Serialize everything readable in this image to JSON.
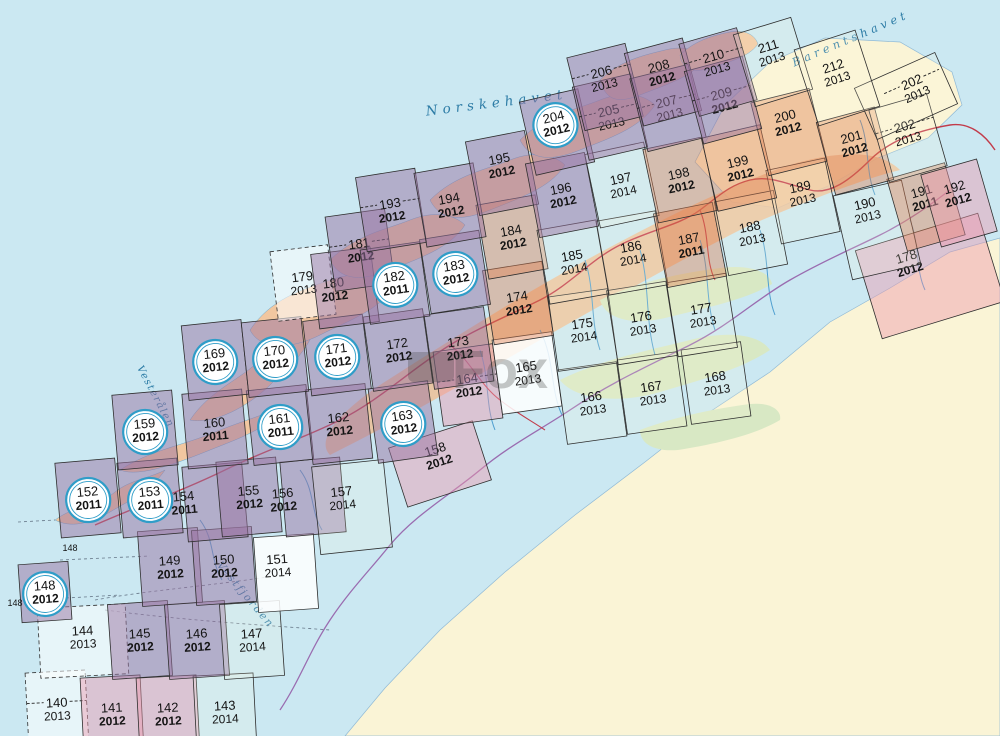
{
  "map": {
    "colors": {
      "sea": "#cbe8f2",
      "paper": "#faf4d6",
      "island": "#f1c7a0",
      "band": "#edbf97",
      "green": "#d8e8c4",
      "river": "#4f9fd0",
      "road": "#c23b4a",
      "border": "#9a6cb0",
      "grid": "#2e2e2e",
      "label": "#141414",
      "circle": "#2f9dc8",
      "sea_text": "#2d7ca6",
      "dashline": "#667788",
      "watermark": "rgba(70,70,70,0.30)",
      "tints": {
        "purple": "rgba(154,116,162,0.50)",
        "pink": "rgba(238,152,172,0.45)",
        "salmon": "rgba(224,128,84,0.42)",
        "white": "rgba(255,255,255,0.85)",
        "whiteSea": "rgba(255,255,255,0.55)",
        "plain": "rgba(255,250,220,0.18)"
      }
    },
    "sea_labels": [
      {
        "id": "norskehavet",
        "t": "Norskehavet",
        "x": 497,
        "y": 107,
        "rot": -7,
        "fs": 13.5,
        "ls": 5
      },
      {
        "id": "barentshavet",
        "t": "Barentshavet",
        "x": 852,
        "y": 42,
        "rot": -23,
        "fs": 11.5,
        "ls": 4
      },
      {
        "id": "vestfjorden",
        "t": "Vestfjorden",
        "x": 243,
        "y": 597,
        "rot": 50,
        "fs": 10.5,
        "ls": 2
      },
      {
        "id": "vesteralen",
        "t": "Vesterålen",
        "x": 153,
        "y": 398,
        "rot": 62,
        "fs": 10,
        "ls": 1.5
      }
    ],
    "extra_labels": [
      {
        "t": "148",
        "x": 70,
        "y": 551
      },
      {
        "t": "148",
        "x": 15,
        "y": 606
      }
    ],
    "watermark": {
      "t": "Fox",
      "x": 500,
      "y": 388
    },
    "sheets": [
      {
        "n": "140",
        "yr": "2013",
        "x": 57,
        "y": 705,
        "rot": -3,
        "tint": "whiteSea",
        "dbox": true,
        "dash": true
      },
      {
        "n": "141",
        "yr": "2012",
        "x": 112,
        "y": 710,
        "rot": -3,
        "tint": "pink"
      },
      {
        "n": "142",
        "yr": "2012",
        "x": 168,
        "y": 710,
        "rot": -3,
        "tint": "pink"
      },
      {
        "n": "143",
        "yr": "2014",
        "x": 225,
        "y": 708,
        "rot": -3,
        "tint": "plain"
      },
      {
        "n": "144",
        "yr": "2013",
        "x": 83,
        "y": 633,
        "rot": -3,
        "tint": "whiteSea",
        "w": 88,
        "h": 70,
        "cdy": 4,
        "dbox": true
      },
      {
        "n": "145",
        "yr": "2012",
        "x": 140,
        "y": 636,
        "rot": -4,
        "tint": "purple"
      },
      {
        "n": "146",
        "yr": "2012",
        "x": 197,
        "y": 636,
        "rot": -4,
        "tint": "purple"
      },
      {
        "n": "147",
        "yr": "2014",
        "x": 252,
        "y": 636,
        "rot": -4,
        "tint": "plain"
      },
      {
        "n": "148",
        "yr": "2012",
        "x": 45,
        "y": 588,
        "rot": -4,
        "tint": "purple",
        "circ": true,
        "w": 50,
        "h": 58
      },
      {
        "n": "149",
        "yr": "2012",
        "x": 170,
        "y": 563,
        "rot": -4,
        "tint": "purple"
      },
      {
        "n": "150",
        "yr": "2012",
        "x": 224,
        "y": 562,
        "rot": -4,
        "tint": "purple"
      },
      {
        "n": "151",
        "yr": "2014",
        "x": 278,
        "y": 561,
        "rot": -4,
        "tint": "white",
        "cdx": 8,
        "cdy": 8
      },
      {
        "n": "152",
        "yr": "2011",
        "x": 88,
        "y": 494,
        "rot": -5,
        "tint": "purple",
        "circ": true
      },
      {
        "n": "153",
        "yr": "2011",
        "x": 150,
        "y": 494,
        "rot": -5,
        "tint": "purple",
        "circ": true
      },
      {
        "n": "154",
        "yr": "2011",
        "x": 184,
        "y": 496,
        "rot": -5,
        "tint": "purple",
        "cdx": 31,
        "cdy": 2
      },
      {
        "n": "155",
        "yr": "2012",
        "x": 249,
        "y": 493,
        "rot": -5,
        "tint": "purple"
      },
      {
        "n": "156",
        "yr": "2012",
        "x": 283,
        "y": 493,
        "rot": -5,
        "tint": "purple",
        "cdx": 30
      },
      {
        "n": "157",
        "yr": "2014",
        "x": 343,
        "y": 493,
        "rot": -6,
        "tint": "plain",
        "w": 72,
        "h": 88,
        "cdx": 9,
        "cdy": 10
      },
      {
        "n": "158",
        "yr": "2012",
        "x": 440,
        "y": 451,
        "rot": -18,
        "tint": "pink",
        "w": 88,
        "h": 62,
        "cdy": 9
      },
      {
        "n": "159",
        "yr": "2012",
        "x": 145,
        "y": 426,
        "rot": -5,
        "tint": "purple",
        "circ": true
      },
      {
        "n": "160",
        "yr": "2011",
        "x": 215,
        "y": 425,
        "rot": -5,
        "tint": "purple"
      },
      {
        "n": "161",
        "yr": "2011",
        "x": 280,
        "y": 421,
        "rot": -6,
        "tint": "purple",
        "circ": true
      },
      {
        "n": "162",
        "yr": "2012",
        "x": 339,
        "y": 420,
        "rot": -6,
        "tint": "purple"
      },
      {
        "n": "163",
        "yr": "2012",
        "x": 403,
        "y": 418,
        "rot": -8,
        "tint": "purple",
        "circ": true
      },
      {
        "n": "164",
        "yr": "2012",
        "x": 468,
        "y": 381,
        "rot": -8,
        "tint": "pink",
        "dash": true
      },
      {
        "n": "165",
        "yr": "2013",
        "x": 527,
        "y": 369,
        "rot": -8,
        "tint": "white"
      },
      {
        "n": "166",
        "yr": "2013",
        "x": 592,
        "y": 399,
        "rot": -8,
        "tint": "plain"
      },
      {
        "n": "167",
        "yr": "2013",
        "x": 652,
        "y": 389,
        "rot": -8,
        "tint": "plain"
      },
      {
        "n": "168",
        "yr": "2013",
        "x": 716,
        "y": 379,
        "rot": -8,
        "tint": "plain"
      },
      {
        "n": "169",
        "yr": "2012",
        "x": 215,
        "y": 356,
        "rot": -6,
        "tint": "purple",
        "circ": true
      },
      {
        "n": "170",
        "yr": "2012",
        "x": 275,
        "y": 353,
        "rot": -6,
        "tint": "purple",
        "circ": true
      },
      {
        "n": "171",
        "yr": "2012",
        "x": 337,
        "y": 351,
        "rot": -7,
        "tint": "purple",
        "circ": true
      },
      {
        "n": "172",
        "yr": "2012",
        "x": 398,
        "y": 346,
        "rot": -8,
        "tint": "purple"
      },
      {
        "n": "173",
        "yr": "2012",
        "x": 459,
        "y": 344,
        "rot": -8,
        "tint": "purple"
      },
      {
        "n": "174",
        "yr": "2012",
        "x": 518,
        "y": 299,
        "rot": -9,
        "tint": "salmon"
      },
      {
        "n": "175",
        "yr": "2014",
        "x": 583,
        "y": 326,
        "rot": -8,
        "tint": "plain"
      },
      {
        "n": "176",
        "yr": "2013",
        "x": 642,
        "y": 319,
        "rot": -9,
        "tint": "plain"
      },
      {
        "n": "177",
        "yr": "2013",
        "x": 702,
        "y": 311,
        "rot": -9,
        "tint": "plain"
      },
      {
        "n": "178",
        "yr": "2012",
        "x": 913,
        "y": 253,
        "rot": -17,
        "tint": "pink",
        "w": 128,
        "h": 92,
        "cdx": 17,
        "cdy": 19
      },
      {
        "n": "179",
        "yr": "2013",
        "x": 303,
        "y": 279,
        "rot": -7,
        "tint": "whiteSea",
        "w": 58,
        "h": 70,
        "dbox": true
      },
      {
        "n": "180",
        "yr": "2012",
        "x": 334,
        "y": 284,
        "rot": -7,
        "tint": "purple",
        "cdx": 11
      },
      {
        "n": "181",
        "yr": "2012",
        "x": 360,
        "y": 246,
        "rot": -8,
        "tint": "purple",
        "dash": true
      },
      {
        "n": "182",
        "yr": "2011",
        "x": 395,
        "y": 279,
        "rot": -8,
        "tint": "purple",
        "circ": true
      },
      {
        "n": "183",
        "yr": "2012",
        "x": 455,
        "y": 268,
        "rot": -9,
        "tint": "purple",
        "circ": true
      },
      {
        "n": "184",
        "yr": "2012",
        "x": 512,
        "y": 233,
        "rot": -10,
        "tint": "salmon"
      },
      {
        "n": "185",
        "yr": "2014",
        "x": 573,
        "y": 258,
        "rot": -10,
        "tint": "plain"
      },
      {
        "n": "186",
        "yr": "2014",
        "x": 632,
        "y": 249,
        "rot": -10,
        "tint": "plain"
      },
      {
        "n": "187",
        "yr": "2011",
        "x": 690,
        "y": 241,
        "rot": -11,
        "tint": "salmon"
      },
      {
        "n": "188",
        "yr": "2013",
        "x": 751,
        "y": 229,
        "rot": -11,
        "tint": "plain"
      },
      {
        "n": "189",
        "yr": "2013",
        "x": 803,
        "y": 189,
        "rot": -12,
        "tint": "plain",
        "cdy": 8
      },
      {
        "n": "190",
        "yr": "2013",
        "x": 871,
        "y": 204,
        "rot": -13,
        "tint": "plain",
        "w": 70,
        "h": 86,
        "cdx": 6,
        "cdy": 22
      },
      {
        "n": "191",
        "yr": "2011",
        "x": 926,
        "y": 193,
        "rot": -16,
        "tint": "salmon",
        "cdy": 10
      },
      {
        "n": "192",
        "yr": "2012",
        "x": 959,
        "y": 189,
        "rot": -16,
        "tint": "pink",
        "w": 58,
        "cdy": 10
      },
      {
        "n": "193",
        "yr": "2012",
        "x": 391,
        "y": 206,
        "rot": -9,
        "tint": "purple",
        "dash": true
      },
      {
        "n": "194",
        "yr": "2012",
        "x": 450,
        "y": 201,
        "rot": -10,
        "tint": "purple"
      },
      {
        "n": "195",
        "yr": "2012",
        "x": 502,
        "y": 161,
        "rot": -11,
        "tint": "purple",
        "cdy": 8
      },
      {
        "n": "196",
        "yr": "2012",
        "x": 562,
        "y": 191,
        "rot": -11,
        "tint": "purple"
      },
      {
        "n": "197",
        "yr": "2014",
        "x": 622,
        "y": 181,
        "rot": -12,
        "tint": "plain"
      },
      {
        "n": "198",
        "yr": "2012",
        "x": 680,
        "y": 176,
        "rot": -12,
        "tint": "salmon"
      },
      {
        "n": "199",
        "yr": "2012",
        "x": 739,
        "y": 164,
        "rot": -13,
        "tint": "salmon"
      },
      {
        "n": "200",
        "yr": "2012",
        "x": 789,
        "y": 118,
        "rot": -14,
        "tint": "salmon",
        "cdy": 10
      },
      {
        "n": "201",
        "yr": "2012",
        "x": 855,
        "y": 139,
        "rot": -15,
        "tint": "salmon",
        "cdy": 8
      },
      {
        "n": "202",
        "yr": "2013",
        "x": 908,
        "y": 128,
        "rot": -16,
        "tint": "plain",
        "cdy": 6,
        "dash": true
      },
      {
        "n": "202",
        "yr": "2013",
        "x": 917,
        "y": 88,
        "rot": -24,
        "tint": "plain",
        "w": 88,
        "h": 56,
        "cdx": -11,
        "cdy": 4,
        "dash": true
      },
      {
        "n": "204",
        "yr": "2012",
        "x": 557,
        "y": 119,
        "rot": -13,
        "tint": "purple",
        "circ": true,
        "cdy": 9
      },
      {
        "n": "205",
        "yr": "2013",
        "x": 610,
        "y": 113,
        "rot": -13,
        "tint": "purple",
        "dash": true
      },
      {
        "n": "206",
        "yr": "2013",
        "x": 605,
        "y": 74,
        "rot": -14,
        "tint": "purple",
        "dash": true,
        "cdy": 9
      },
      {
        "n": "207",
        "yr": "2013",
        "x": 668,
        "y": 104,
        "rot": -14,
        "tint": "purple",
        "dash": true
      },
      {
        "n": "208",
        "yr": "2012",
        "x": 663,
        "y": 68,
        "rot": -15,
        "tint": "purple",
        "cdy": 10
      },
      {
        "n": "209",
        "yr": "2012",
        "x": 723,
        "y": 96,
        "rot": -15,
        "tint": "purple",
        "dash": true
      },
      {
        "n": "210",
        "yr": "2013",
        "x": 718,
        "y": 58,
        "rot": -16,
        "tint": "purple",
        "dash": true,
        "cdy": 10
      },
      {
        "n": "211",
        "yr": "2013",
        "x": 773,
        "y": 48,
        "rot": -17,
        "tint": "plain",
        "cdy": 10
      },
      {
        "n": "212",
        "yr": "2013",
        "x": 837,
        "y": 68,
        "rot": -18,
        "tint": "plain",
        "w": 64,
        "h": 80,
        "cdy": 6
      }
    ],
    "base_paths": {
      "land_main": "M1000,238 L950,252 890,288 830,322 770,372 705,415 645,462 575,515 505,572 440,630 385,688 345,736 L1000,736 Z",
      "land_ne": "M695,162 L725,105 770,62 825,38 900,42 952,72 962,105 928,138 878,158 828,186 778,208 732,202 Z",
      "islands": [
        "M55,520 C75,505 100,505 115,492 C130,480 150,478 165,470 C150,492 130,500 110,512 C90,524 70,528 55,520 Z",
        "M120,470 C150,450 185,445 215,432 C245,420 265,415 285,405 C270,428 240,438 210,450 C180,462 140,478 120,470 Z",
        "M190,420 C210,390 240,380 260,360 C280,340 300,335 315,325 C310,350 290,365 270,385 C250,405 215,425 190,420 Z",
        "M250,330 C270,300 300,290 330,280 C360,270 380,275 395,285 C380,310 350,320 320,335 C290,350 260,350 250,330 Z",
        "M330,260 C355,235 385,230 410,220 C435,210 455,215 465,225 C450,248 420,258 390,270 C360,282 340,280 330,260 Z",
        "M430,200 C455,175 485,170 510,160 C535,150 555,155 565,165 C550,188 520,198 490,210 C460,222 440,220 430,200 Z",
        "M520,140 C545,115 575,110 600,100 C625,90 645,95 655,105 C640,128 610,138 580,150 C550,162 530,160 520,140 Z",
        "M600,80 C620,60 645,55 665,50 C685,45 700,50 705,60 C690,78 665,85 640,95 C615,105 605,98 600,80 Z",
        "M680,55 C695,40 715,35 730,32 C745,29 755,35 758,44 C748,58 728,62 710,68 C692,74 682,68 680,55 Z"
      ],
      "band": "M330,455 C400,420 470,380 540,340 C610,300 680,260 750,225 C810,200 860,180 900,170 C880,150 840,150 790,165 C730,185 660,220 590,258 C520,296 450,340 380,385 C340,412 315,440 330,455 Z",
      "greens": [
        "M560,380 C600,360 650,350 690,340 C730,330 760,335 770,350 C740,370 700,380 660,392 C620,404 575,400 560,380 Z",
        "M600,300 C640,280 690,272 720,268 C750,264 770,272 772,284 C745,300 705,308 665,318 C630,326 605,318 600,300 Z",
        "M640,430 C680,415 720,408 750,404 C770,402 782,410 780,420 C755,435 715,444 678,450 C655,452 640,444 640,430 Z"
      ],
      "rivers": [
        "M585,260 C595,290 590,320 600,350",
        "M640,250 C650,285 645,320 655,355",
        "M700,240 C710,270 705,300 715,330",
        "M540,330 C555,360 550,390 562,415",
        "M480,350 C490,380 485,405 495,430",
        "M300,470 C315,490 310,510 322,530",
        "M200,520 C215,540 210,560 222,580",
        "M760,230 C770,260 765,290 775,315",
        "M860,120 C870,145 865,170 875,195",
        "M910,220 C920,245 915,268 925,290"
      ],
      "road_main": "M95,525 C140,505 180,492 225,470 C270,448 300,440 340,420 C380,400 410,370 450,345 C480,327 510,315 540,300 C570,285 590,260 620,245 C650,230 680,225 700,210 C720,195 730,185 750,180 C770,175 790,185 810,190 C830,195 850,180 870,160 C890,140 920,130 950,125 C970,122 985,135 995,150",
      "road_branches": [
        "M450,345 C470,360 480,385 500,400 C515,412 530,420 545,430",
        "M700,210 C710,235 705,260 715,280"
      ],
      "border": "M280,710 C300,680 310,650 330,620 C350,590 370,570 390,545 C415,515 450,495 480,470 C510,445 540,430 570,410 C610,383 650,365 690,345 C730,325 755,300 790,280 C825,260 850,250 880,235 C910,220 930,205 950,190",
      "sea_dashes": [
        "M30,600 L120,595",
        "M60,560 L150,556",
        "M95,600 C150,590 220,585 280,575",
        "M105,610 C180,620 260,625 330,630",
        "M18,522 L55,520"
      ]
    }
  }
}
